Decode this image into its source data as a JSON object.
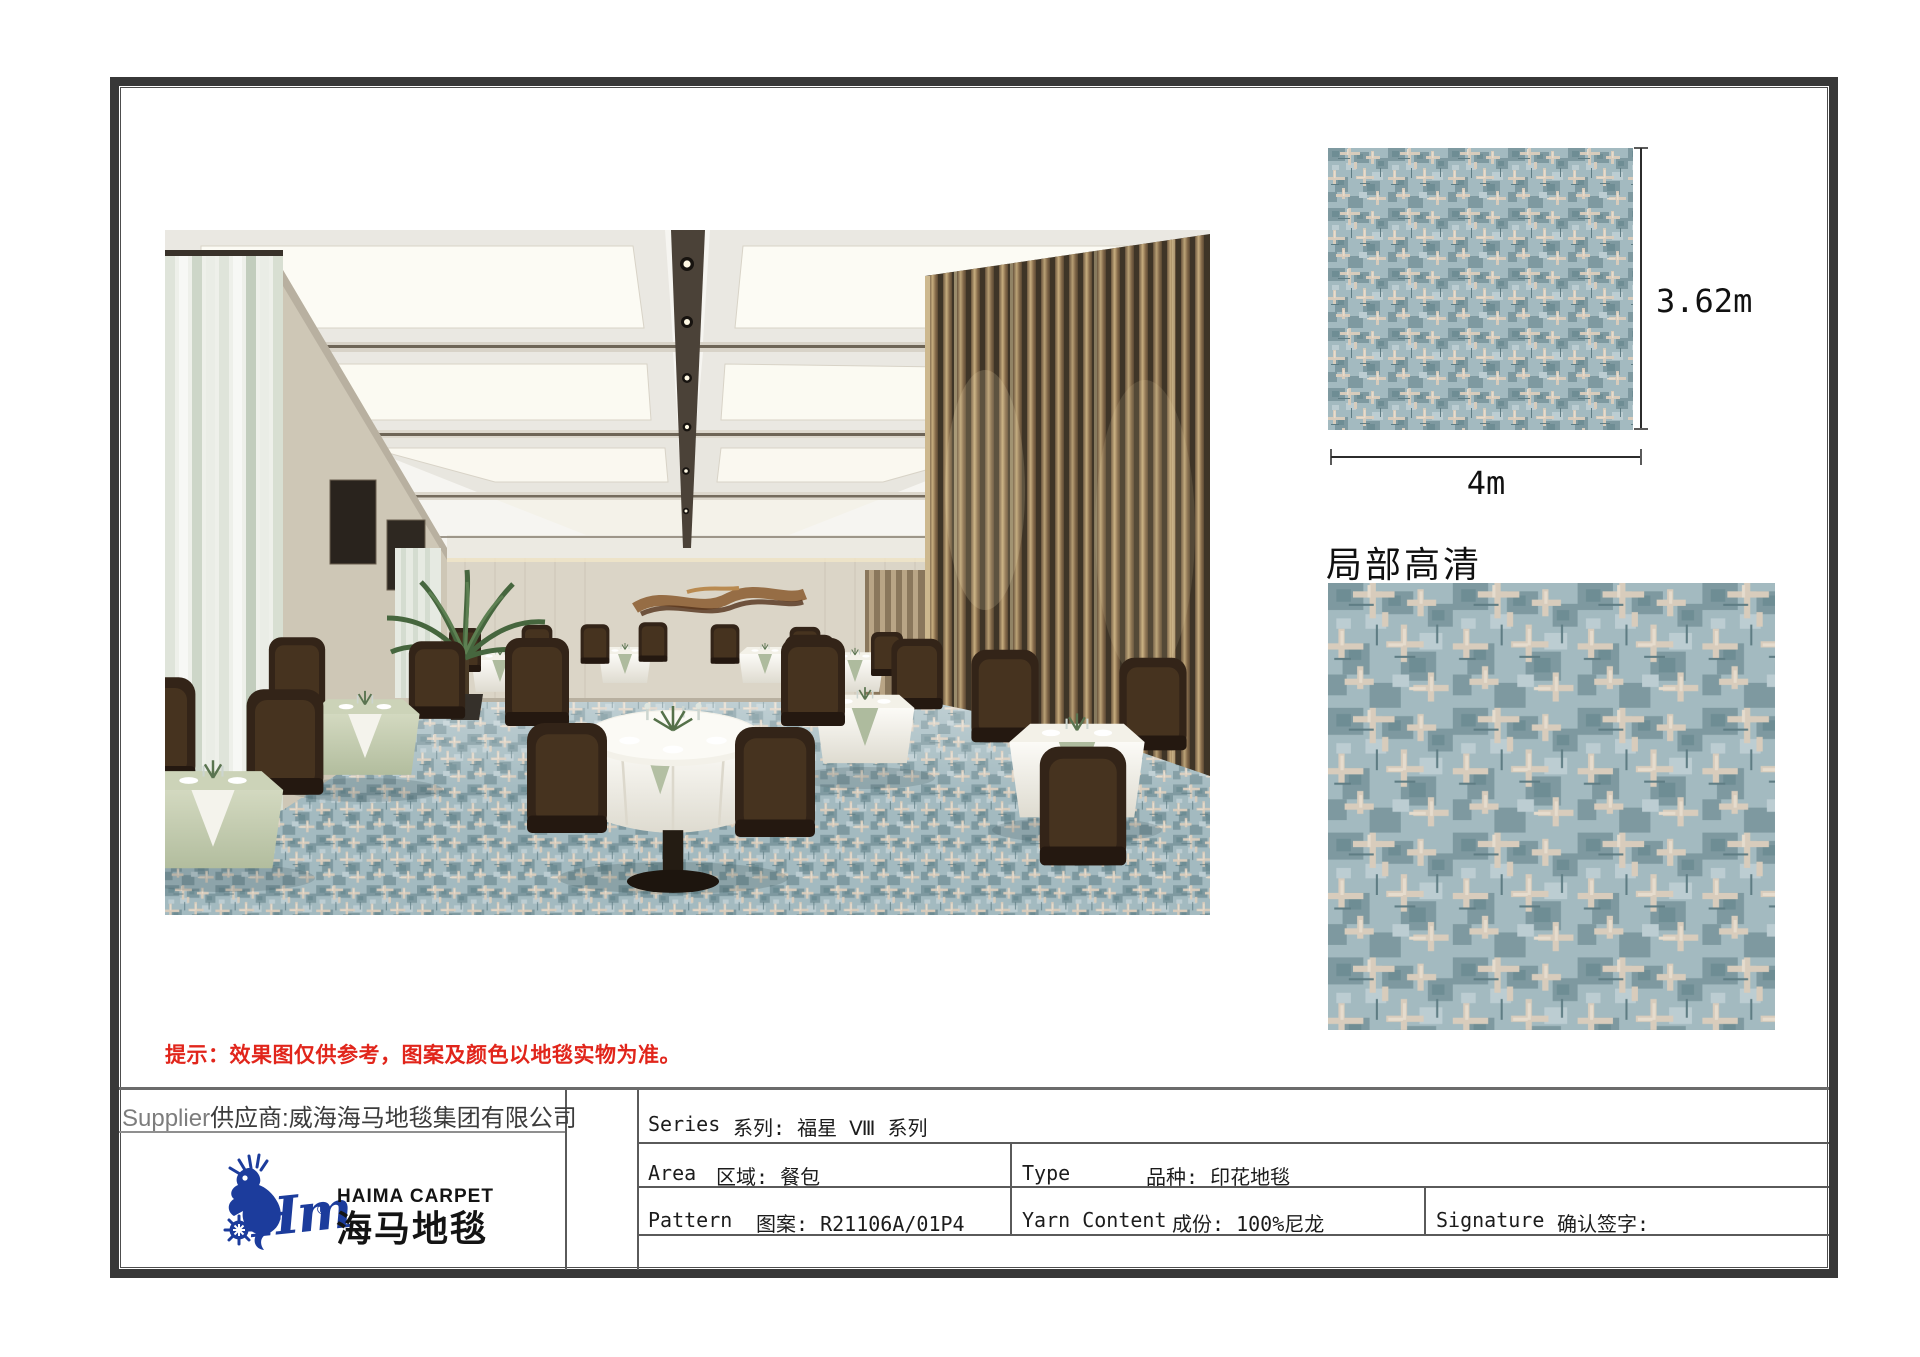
{
  "dimensions": {
    "height": "3.62m",
    "width": "4m"
  },
  "detail": {
    "title": "局部高清"
  },
  "notice": {
    "text": "提示：效果图仅供参考，图案及颜色以地毯实物为准。",
    "color": "#e1251b"
  },
  "supplier": {
    "en": "Supplier",
    "cn": "供应商:威海海马地毯集团有限公司"
  },
  "logo": {
    "en": "HAIMA CARPET",
    "cn": "海马地毯",
    "script": "Hm",
    "reg": "®",
    "color": "#1c3c9c"
  },
  "specs": {
    "series_en": "Series",
    "series_cn": "系列: 福星 Ⅷ 系列",
    "area_en": "Area",
    "area_cn": "区域: 餐包",
    "type_en": "Type",
    "type_cn": "品种: 印花地毯",
    "pattern_en": "Pattern",
    "pattern_cn": "图案: R21106A/01P4",
    "yarn_en": "Yarn Content",
    "yarn_cn": "成份: 100%尼龙",
    "signature_en": "Signature",
    "signature_cn": "确认签字:"
  },
  "colors": {
    "carpet_base": "#a3bac0",
    "carpet_teal": "#7e99a0",
    "carpet_beige": "#d8ccbc",
    "frame": "#383838",
    "logo_blue": "#1c3c9c"
  }
}
